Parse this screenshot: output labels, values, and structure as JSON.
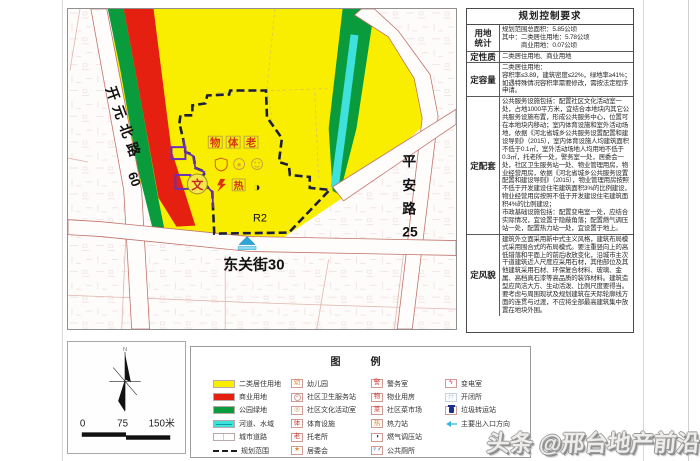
{
  "map": {
    "roads": {
      "kaiyuan": "开元北路",
      "kaiyuan_no": "60",
      "dongguan": "东关街30",
      "pingan": [
        "平",
        "安",
        "路",
        "25"
      ]
    },
    "parcel_code": "R2",
    "relic_marker": "文",
    "facility_chars": [
      "物",
      "体",
      "老"
    ],
    "heat_char": "热",
    "colors": {
      "residential_yellow": "#F9EE00",
      "commercial_red": "#E52011",
      "park_green": "#0A9B3C",
      "water_cyan": "#3EE1DC",
      "boundary_dash": "#1c1c3c",
      "purple_accent": "#6A2FB8",
      "road_edge": "#c2736b"
    }
  },
  "compass": {
    "north_label": "N",
    "scale": {
      "start": "0",
      "mid": "75",
      "end": "150米"
    }
  },
  "table": {
    "title": "规划控制要求",
    "rows": [
      {
        "label": "用地\n统计",
        "content": "规划范围总面积：5.85公顷\n其中：二类居住用地：5.78公顷\n　　　商业用地：0.07公顷"
      },
      {
        "label": "定性质",
        "content": "二类居住用地、商业用地"
      },
      {
        "label": "定容量",
        "content": "二类居住用地：\n容积率≤3.89，建筑密度≤22%，绿地率≥41%；如遇特殊情况容积率需要修改，需按法定程序申请。"
      },
      {
        "label": "定配套",
        "content": "公共服务设施包括：配置社区文化活动室一处，占地1000平方米，宜结合本地块内其它公共服务设施布置，形成公共服务中心，位置可在本地块内移动；室内体育设施和室外活动场地，依据《河北省城乡公共服务设置配置和建设导则》（2015），室内体育设施人均建筑面积不低于0.1㎡，室外活动场地人均用地不低于0.3㎡，托老所一处，警务室一处，居委会一处，社区卫生服务站一处、物业管理用房，物业经营用房，依据《河北省城乡公共服务设置配置和建设导则》（2015），物业管理用房按照不低于开发建设住宅建筑面积3%的比例建设，物业经营用房按照不低于开发建设住宅建筑面积4%的比例建设；\n市政基础设施包括：配置变电室一处，应结合实际情况，宜设置于隐蔽角落；配置燃气调压站一处，配置热力站一处，宜设置于地上。"
      },
      {
        "label": "定风貌",
        "content": "建筑外立面采用新中式主义风格，建筑布局模式采用围合式的布局模式。要注重竖向上的高低错落和平面上的前后收放变化，沿城市主次干道建筑近人尺度应采用石材，其他部位及其他建筑采用石材、环保复合材料、玻璃、金属、高档真石漆等高品质的装饰材料。建筑造型应简洁大方、生动活泼、比例尺度要得当。要考虑与周围现状及规划建筑在天际轮廓线方面的连贯与过渡，不应将全部最高建筑集中放置在地块外围。"
      }
    ]
  },
  "legend": {
    "title": "图　例",
    "col1": [
      {
        "icon": "sw-yellow",
        "char": "",
        "cls": "",
        "label": "二类居住用地"
      },
      {
        "icon": "sw-red",
        "char": "",
        "cls": "",
        "label": "商业用地"
      },
      {
        "icon": "sw-green",
        "char": "",
        "cls": "",
        "label": "公园绿地"
      },
      {
        "icon": "sw-cyan",
        "char": "",
        "cls": "",
        "label": "河道、水域"
      },
      {
        "icon": "sw-road",
        "char": "",
        "cls": "",
        "label": "城市道路"
      },
      {
        "icon": "sw-dash",
        "char": "",
        "cls": "",
        "label": "规划范围"
      }
    ],
    "col2": [
      {
        "icon": "bx",
        "char": "幼",
        "cls": "c-orange",
        "label": "幼儿园"
      },
      {
        "icon": "bx",
        "char": "+",
        "cls": "circ",
        "label": "社区卫生服务站"
      },
      {
        "icon": "bx",
        "char": "◎",
        "cls": "c-tan",
        "label": "社区文化活动室"
      },
      {
        "icon": "bx",
        "char": "体",
        "cls": "c-red",
        "label": "体育设施"
      },
      {
        "icon": "bx",
        "char": "老",
        "cls": "c-red",
        "label": "托老所"
      },
      {
        "icon": "bx",
        "char": "★",
        "cls": "c-orange",
        "label": "居委会"
      }
    ],
    "col3": [
      {
        "icon": "bx",
        "char": "警",
        "cls": "c-red",
        "label": "警务室"
      },
      {
        "icon": "bx",
        "char": "物",
        "cls": "c-red",
        "label": "物业用房"
      },
      {
        "icon": "bx",
        "char": "菜",
        "cls": "c-red",
        "label": "社区菜市场"
      },
      {
        "icon": "bx",
        "char": "热",
        "cls": "c-orange",
        "label": "热力站"
      },
      {
        "icon": "bx",
        "char": "◑",
        "cls": "c-navy",
        "label": "燃气调压站"
      },
      {
        "icon": "bx",
        "char": "♀♂",
        "cls": "c-navy",
        "label": "公共厕所"
      }
    ],
    "col4": [
      {
        "icon": "bx",
        "char": "ϟ",
        "cls": "c-pink",
        "label": "变电室"
      },
      {
        "icon": "bx-light",
        "char": "开",
        "cls": "c-light",
        "label": "开闭所"
      },
      {
        "icon": "bx",
        "char": "",
        "cls": "trash",
        "label": "垃圾转运站"
      },
      {
        "icon": "bx-none",
        "char": "",
        "cls": "arrow",
        "label": "主要出入口方向"
      }
    ]
  },
  "watermark": "头条 @邢台地产前沿"
}
